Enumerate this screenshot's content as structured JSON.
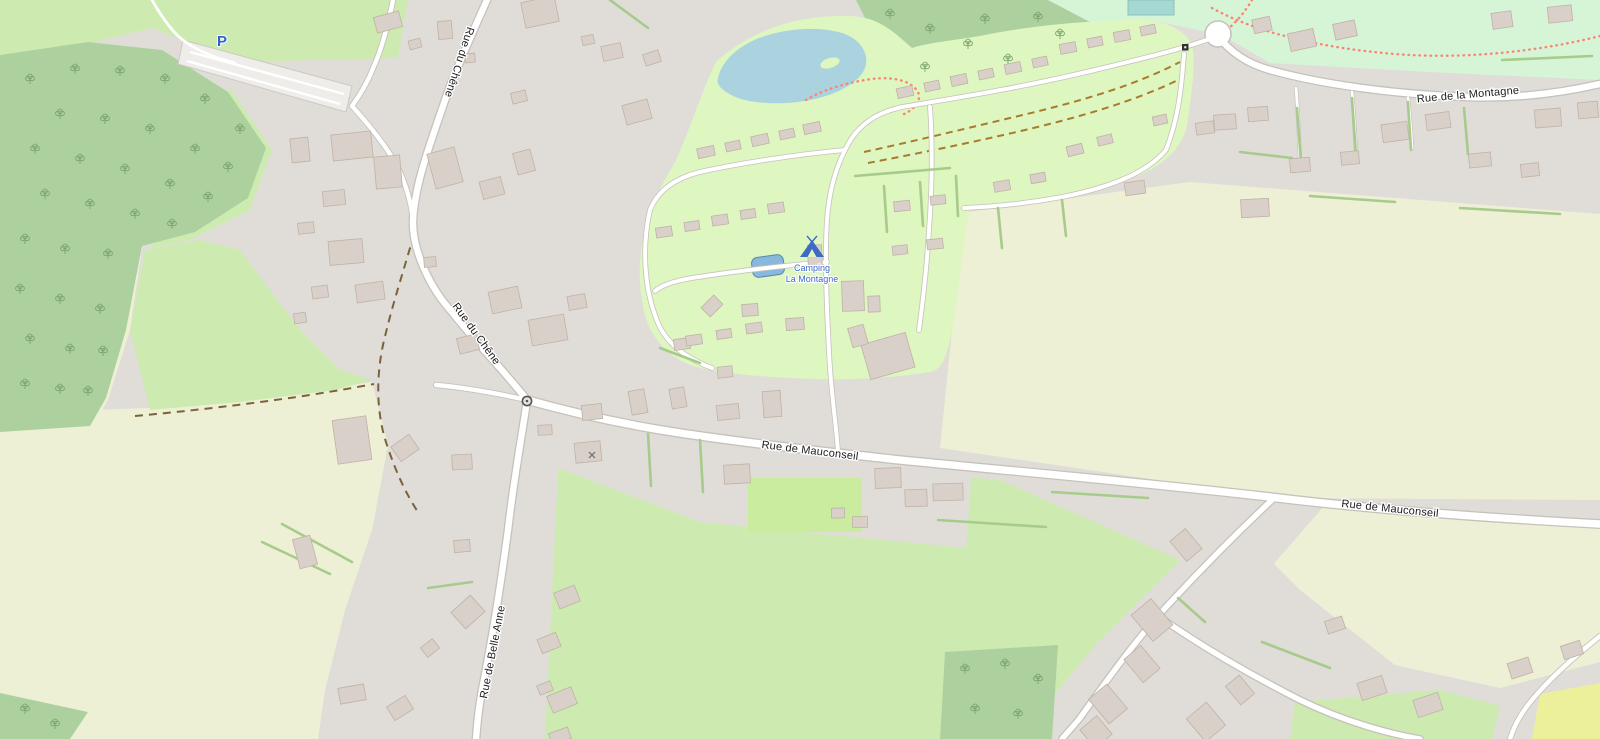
{
  "map": {
    "description": "Street map of a village with campground",
    "road_labels": [
      {
        "id": "rue-du-chene-north",
        "text": "Rue du Chêne"
      },
      {
        "id": "rue-du-chene-south",
        "text": "Rue du Chêne"
      },
      {
        "id": "rue-de-belle-anne",
        "text": "Rue de Belle Anne"
      },
      {
        "id": "rue-de-mauconseil-west",
        "text": "Rue de Mauconseil"
      },
      {
        "id": "rue-de-mauconseil-east",
        "text": "Rue de Mauconseil"
      },
      {
        "id": "rue-de-la-montagne",
        "text": "Rue de la Montagne"
      }
    ],
    "pois": [
      {
        "id": "camping",
        "icon": "tent-icon",
        "label_line1": "Camping",
        "label_line2": "La Montagne",
        "color": "#3d6ac5"
      },
      {
        "id": "parking",
        "icon": "parking-icon",
        "label": "P",
        "color": "#2b64c9"
      }
    ],
    "markers": [
      {
        "id": "gate",
        "icon": "gate-icon"
      },
      {
        "id": "barrier",
        "icon": "barrier-icon"
      },
      {
        "id": "cross",
        "icon": "cross-icon"
      }
    ],
    "legend_colors": {
      "residential": "#e0ddd9",
      "farmland": "#eef0d5",
      "meadow": "#cdebb0",
      "forest": "#add19e",
      "camp_site": "#def6c0",
      "leisure_green": "#d6f5d6",
      "water": "#aad3df",
      "pool": "#a5d8d2",
      "building": "#d9d0c9",
      "road_fill": "#ffffff",
      "road_casing": "#c6c2bb",
      "hedge": "#a7cb8b",
      "track": "#7a6339",
      "footpath": "#fc8372"
    }
  }
}
